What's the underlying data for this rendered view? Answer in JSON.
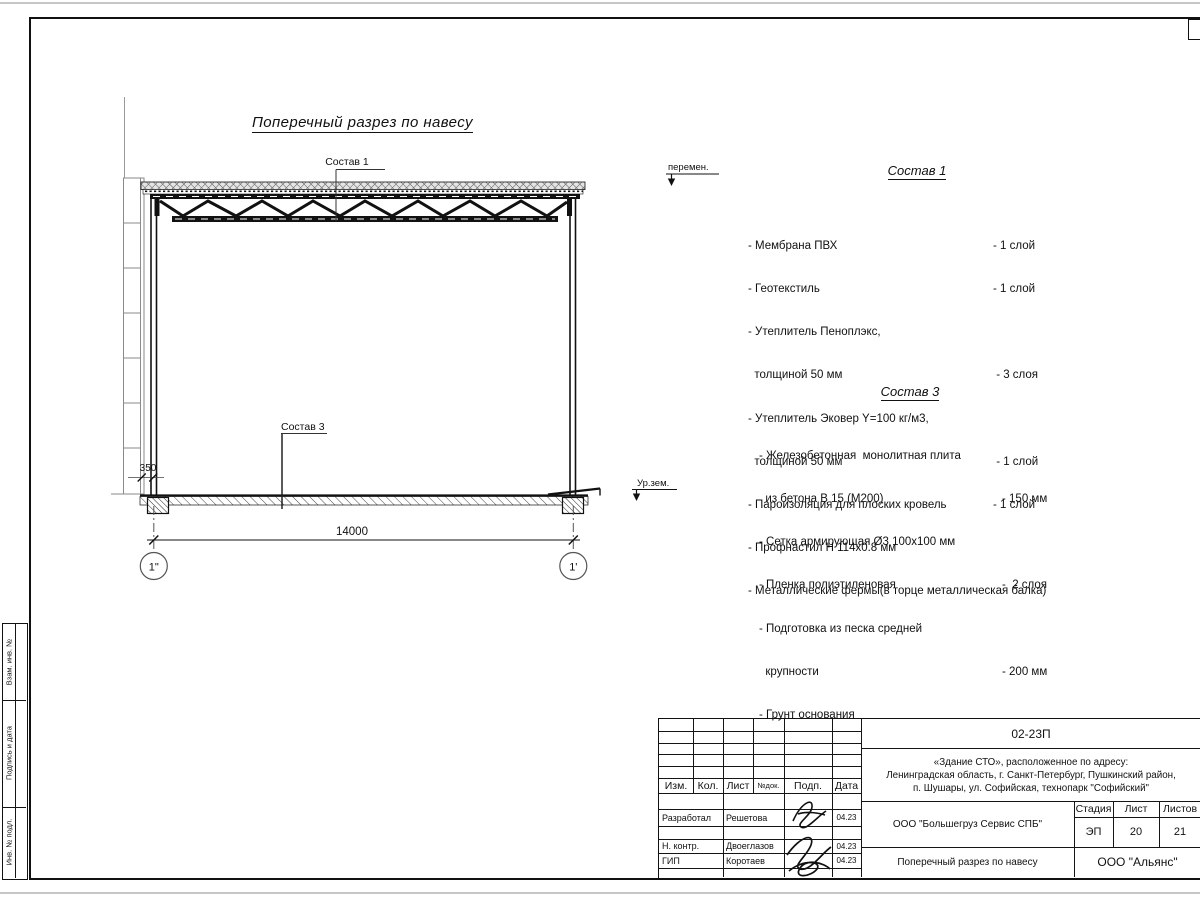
{
  "drawing": {
    "title": "Поперечный разрез по навесу",
    "callout1": "Состав 1",
    "callout3": "Состав 3",
    "peremen": "перемен.",
    "ur_zem": "Ур.зем.",
    "dim_350": "350",
    "dim_14000": "14000",
    "axis_left": "1\"",
    "axis_right": "1'"
  },
  "sostav1": {
    "title": "Состав 1",
    "items": [
      {
        "name": "- Мембрана ПВХ",
        "qty": "- 1 слой"
      },
      {
        "name": "- Геотекстиль",
        "qty": "- 1 слой"
      },
      {
        "name": "- Утеплитель Пеноплэкс,",
        "qty": ""
      },
      {
        "name": "  толщиной 50 мм",
        "qty": " - 3 слоя"
      },
      {
        "name": "- Утеплитель Эковер Y=100 кг/м3,",
        "qty": ""
      },
      {
        "name": "  толщиной 50 мм",
        "qty": " - 1 слой"
      },
      {
        "name": "- Пароизоляция для плоских кровель",
        "qty": "- 1 слой"
      },
      {
        "name": "- Профнастил Н 114х0.8 мм",
        "qty": ""
      },
      {
        "name": "- Металлические фермы(в торце металлическая балка)",
        "qty": ""
      }
    ]
  },
  "sostav3": {
    "title": "Состав 3",
    "items": [
      {
        "name": "- Железобетонная  монолитная плита",
        "qty": ""
      },
      {
        "name": "  из бетона В 15 (М200)",
        "qty": "- 150 мм"
      },
      {
        "name": "- Сетка армирующая Ø3 100х100 мм",
        "qty": ""
      },
      {
        "name": "- Пленка полиэтиленовая",
        "qty": "-  2 слоя"
      },
      {
        "name": "- Подготовка из песка средней",
        "qty": ""
      },
      {
        "name": "  крупности",
        "qty": "- 200 мм"
      },
      {
        "name": "- Грунт основания",
        "qty": ""
      }
    ]
  },
  "left_margin": {
    "cell1": "Взам. инв. №",
    "cell2": "Подпись и дата",
    "cell3": "Инв. № подл."
  },
  "title_block": {
    "doc_code": "02-23П",
    "object_line1": "«Здание СТО», расположенное по адресу:",
    "object_line2": "Ленинградская область, г. Санкт-Петербург, Пушкинский район,",
    "object_line3": "п. Шушары, ул. Софийская, технопарк \"Софийский\"",
    "cols": {
      "izm": "Изм.",
      "kol": "Кол.",
      "list": "Лист",
      "ndok": "№док.",
      "podp": "Подп.",
      "data": "Дата"
    },
    "rows": [
      {
        "role": "Разработал",
        "name": "Решетова",
        "date": "04.23"
      },
      {
        "role": "Н. контр.",
        "name": "Двоеглазов",
        "date": "04.23"
      },
      {
        "role": "ГИП",
        "name": "Коротаев",
        "date": "04.23"
      }
    ],
    "company": "ООО \"Большегруз Сервис СПБ\"",
    "sheet_title": "Поперечный разрез по навесу",
    "org": "ООО \"Альянс\"",
    "stage": {
      "h1": "Стадия",
      "h2": "Лист",
      "h3": "Листов",
      "v1": "ЭП",
      "v2": "20",
      "v3": "21"
    }
  }
}
